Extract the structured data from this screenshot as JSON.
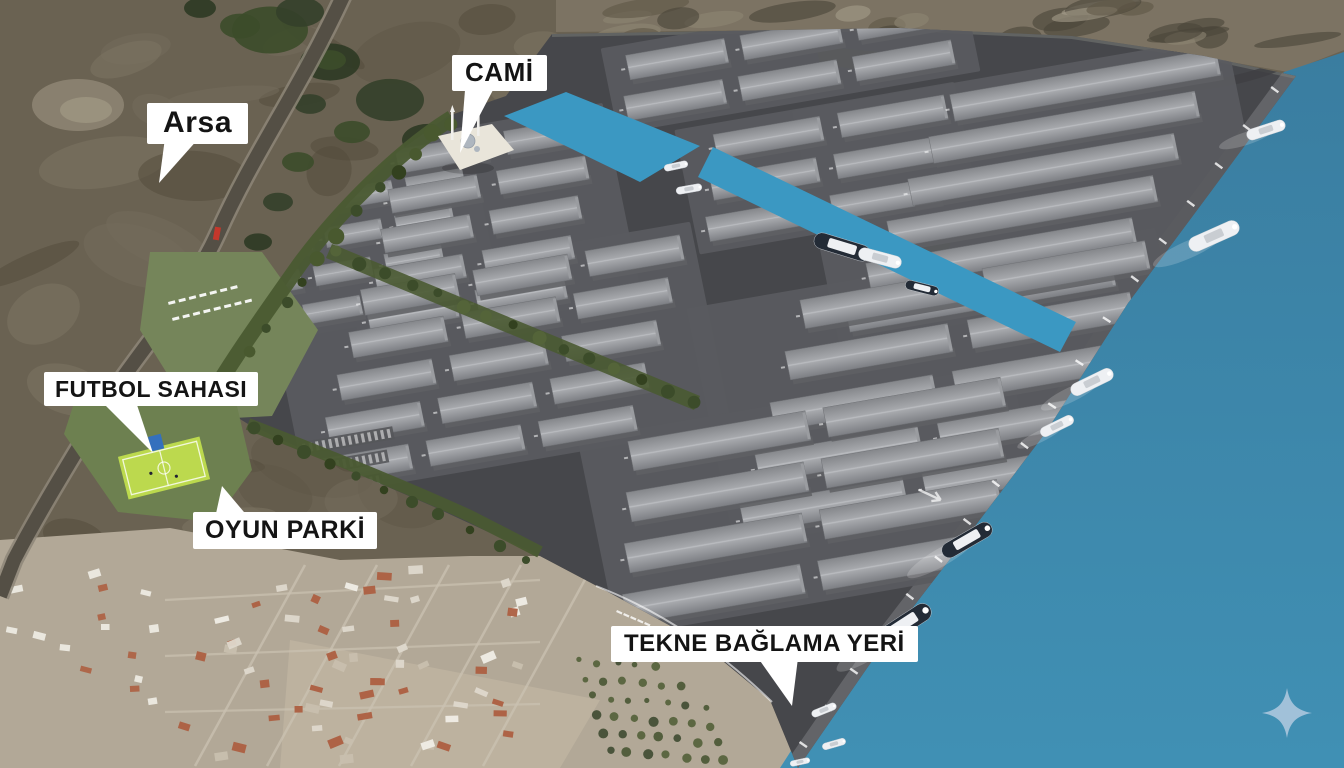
{
  "title": "Industrial marina site plan aerial rendering",
  "labels": {
    "arsa": "Arsa",
    "cami": "CAMİ",
    "futbol_sahasi": "FUTBOL SAHASI",
    "oyun_parki": "OYUN PARKİ",
    "tekne_baglama_yeri": "TEKNE BAĞLAMA YERİ"
  },
  "watermark": {
    "icon": "sparkle-icon",
    "color": "#a9c6dc"
  },
  "colors": {
    "sea_top": "#3a7da0",
    "sea_bottom": "#4090b4",
    "canal": "#3b98c2",
    "platform": "#46474b",
    "apron": "#5a5b5f",
    "quay_band": "#636468",
    "roof_light": "#a6a8ac",
    "roof_dark": "#85878b",
    "ridge": "#bcbec2",
    "building_wall": "#5f6064",
    "gable": "#9a9ca0",
    "terrain": "#6a6252",
    "terrain_dark": "#51493a",
    "terrain_light": "#7d7564",
    "hills": "#7c7363",
    "quarry": "#8d8472",
    "village": "#b2a897",
    "village_field": "#beb3a0",
    "house": "#f0ede6",
    "roof_red": "#ad5f41",
    "street": "#cbc2b2",
    "green_dark": "#33411f",
    "green_mid": "#4a5a32",
    "lawn": "#75855a",
    "field": "#bcd94e",
    "goal_blue": "#3470bd",
    "highway": "#544f45",
    "highway_edge": "#8d8678",
    "label_bg": "#ffffff",
    "label_text": "#141414",
    "boat_white": "#eef0f3",
    "boat_dark": "#232b36",
    "marker_red": "#c4372b",
    "tick": "#ffffff",
    "mosque": "#e9e5da",
    "dome": "#aeb6bf"
  }
}
